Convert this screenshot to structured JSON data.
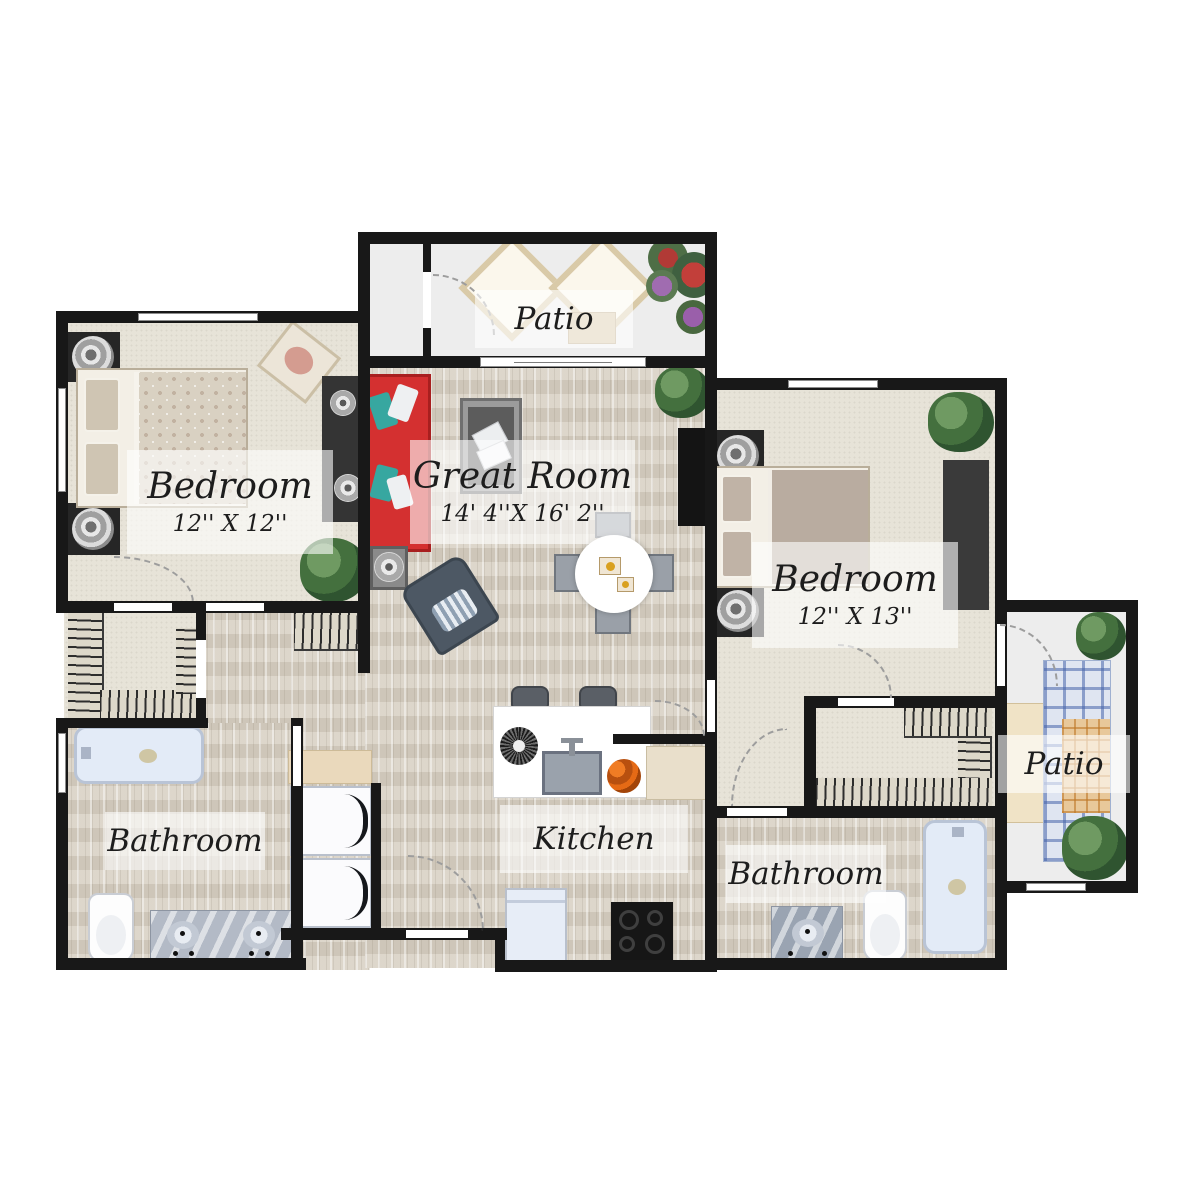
{
  "plan": {
    "title": "Two bedroom two bathroom apartment floor plan",
    "rooms": {
      "patio_top": {
        "label": "Patio"
      },
      "great_room": {
        "label": "Great Room",
        "dimensions": "14' 4''X 16' 2''"
      },
      "bedroom_left": {
        "label": "Bedroom",
        "dimensions": "12'' X 12''"
      },
      "bedroom_right": {
        "label": "Bedroom",
        "dimensions": "12'' X 13''"
      },
      "kitchen": {
        "label": "Kitchen"
      },
      "bathroom_left": {
        "label": "Bathroom"
      },
      "bathroom_right": {
        "label": "Bathroom"
      },
      "patio_right": {
        "label": "Patio"
      }
    },
    "colors": {
      "wall": "#181818",
      "carpet": "#e7e3d8",
      "wood_floor": "#d8d1c4",
      "patio_floor": "#ededed",
      "sofa_red": "#d43030",
      "pillow_teal": "#37a7a0",
      "label_background": "rgba(255,255,255,0.60)",
      "label_text": "#1d1d1d"
    }
  }
}
